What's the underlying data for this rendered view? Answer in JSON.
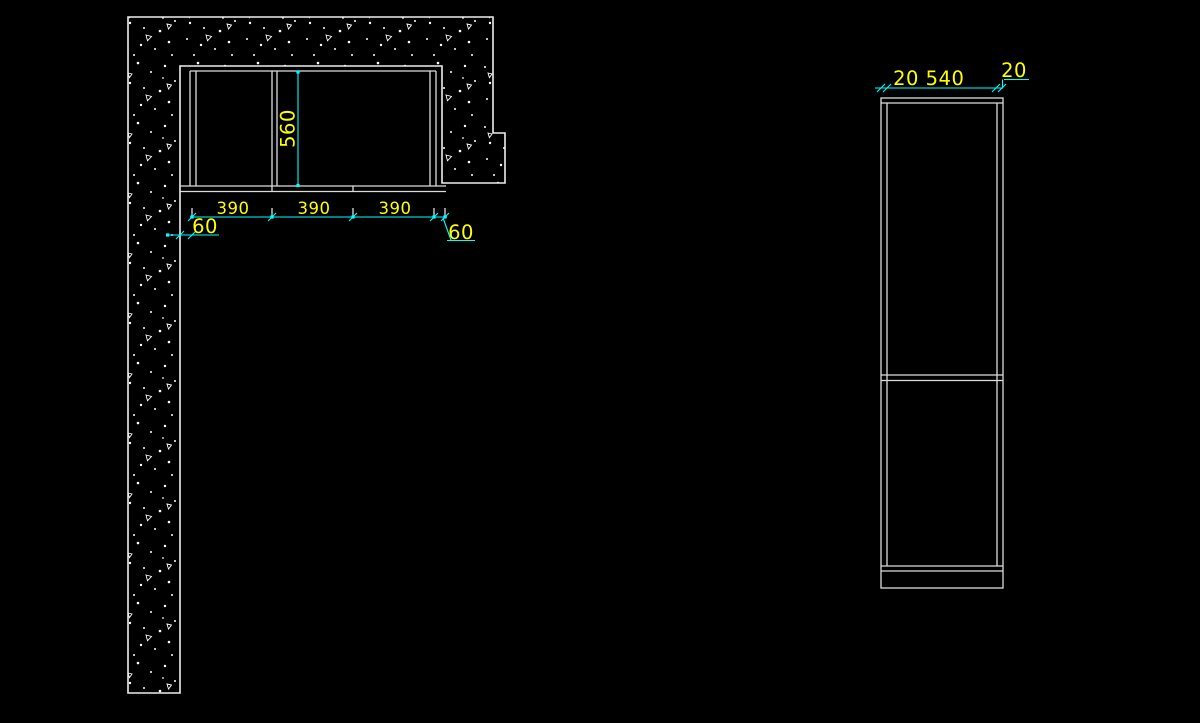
{
  "canvas": {
    "background": "#000000",
    "width": 1200,
    "height": 723
  },
  "colors": {
    "geometry": "#dcdcdc",
    "wall_outline": "#ededed",
    "stipple": "#ffffff",
    "dimension_line": "#00ffff",
    "dimension_text": "#ffff00"
  },
  "plan_view": {
    "description": "corner-wall-plan-with-base-cabinets",
    "width_labels": [
      "390",
      "390",
      "390"
    ],
    "left_offset_label": "60",
    "right_offset_label": "60",
    "depth_label": "560"
  },
  "side_view": {
    "description": "tall-cabinet-elevation",
    "left_panel_label": "20",
    "width_label": "540",
    "right_panel_label": "20"
  }
}
